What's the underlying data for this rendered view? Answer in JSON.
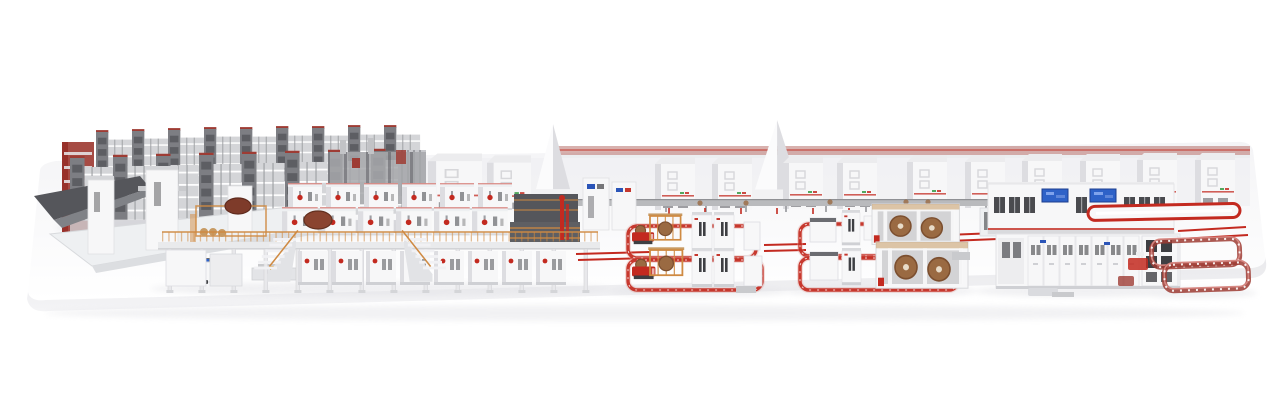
{
  "scene": {
    "type": "3d-product-render",
    "subject": "complete-corrugated-board-production-line",
    "sections": [
      "automated-roll-storage-racks",
      "infeed-ramp",
      "prefeeder-table",
      "agv-shuttle",
      "corrugator-wet-end",
      "mezzanine-platform",
      "staircases",
      "background-machine-halls",
      "roll-transport-conveyor",
      "splicer-agv-cell",
      "reel-stand-cell",
      "agv-guide-loops",
      "dry-end-converting-line",
      "operator-screens",
      "outfeed-conveyor-loops",
      "factory-platform"
    ]
  },
  "palette": {
    "page-bg": "#ffffff",
    "platform-top": "#f4f4f6",
    "platform-front": "#e9e9ec",
    "platform-edge": "#dcdce0",
    "shadow": "#e2e2e6",
    "machine-white": "#f7f7f8",
    "machine-light": "#ececee",
    "machine-shade": "#dddde1",
    "panel-gray": "#c7c8cc",
    "steel-gray": "#9d9ea3",
    "rack-gray": "#7d7e83",
    "dark-gray": "#55565b",
    "slot-dark": "#3e3f43",
    "accent-red": "#c32a20",
    "trim-red": "#c5372e",
    "soft-red": "#d98b85",
    "dark-red": "#8f2019",
    "maroon": "#9e3c34",
    "orange": "#cf8a42",
    "tan": "#c79a63",
    "roll-brown": "#9a6a42",
    "roll-dark": "#7c4f2f",
    "screen-blue": "#2e62c8",
    "label-blue": "#2b55b8",
    "logo-green": "#3f9e4d"
  }
}
